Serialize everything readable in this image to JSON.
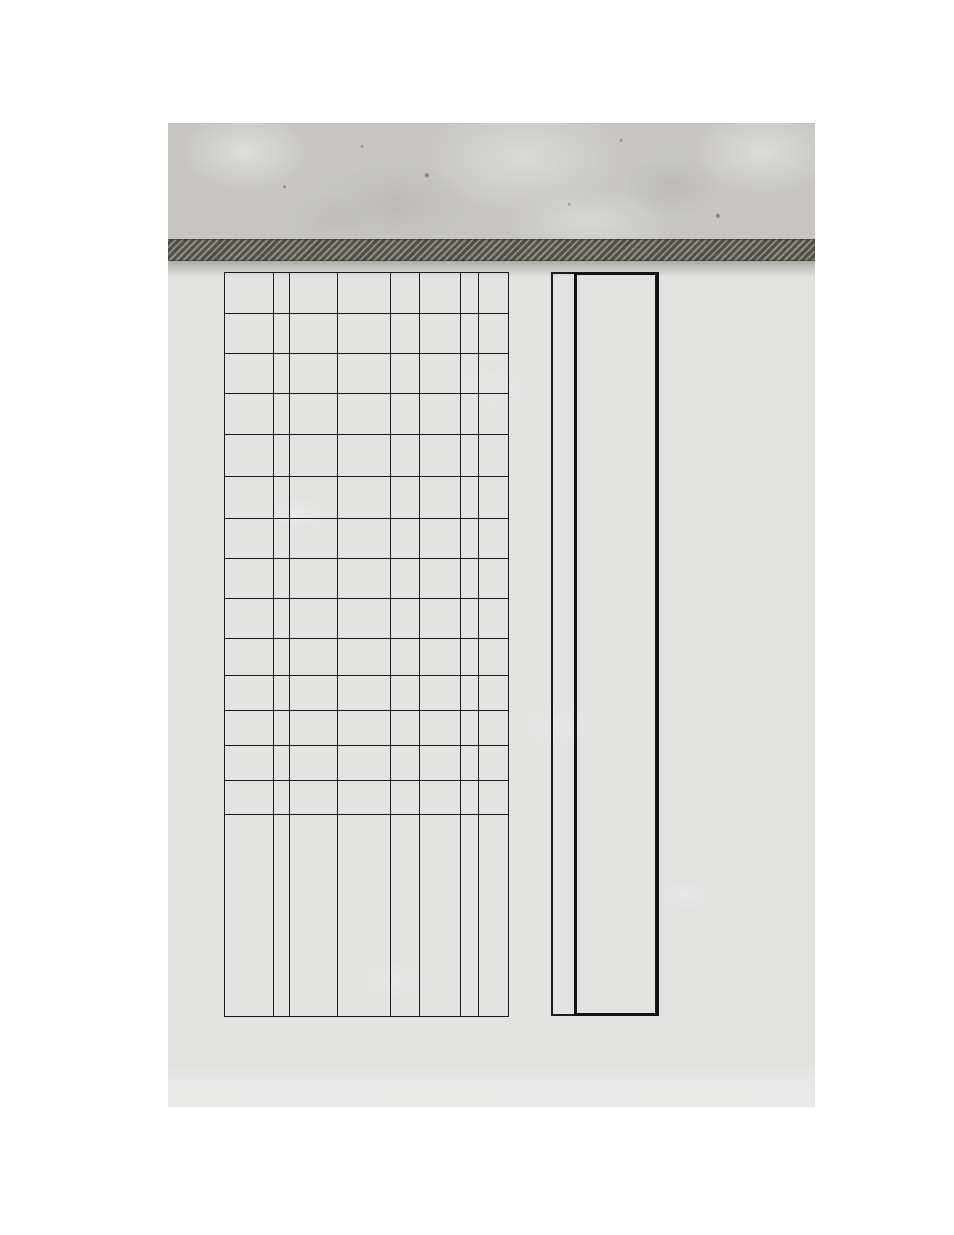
{
  "canvas": {
    "width_px": 954,
    "height_px": 1235,
    "background_color": "#ffffff"
  },
  "page": {
    "left_px": 168,
    "top_px": 123,
    "width_px": 647,
    "height_px": 984,
    "regions": {
      "concrete_header": {
        "height_px": 116,
        "base_color": "#c7c6c3"
      },
      "woven_band": {
        "top_px": 116,
        "height_px": 22,
        "base_color": "#66665a",
        "stripe_light": "#96968a",
        "stripe_dark": "#4e4e44"
      },
      "paper_body": {
        "top_px": 138,
        "color": "#e2e2e1"
      }
    }
  },
  "ledger_table": {
    "left_px": 56,
    "top_px": 149,
    "width_px": 284,
    "height_px": 744,
    "line_color": "#1a1a1a",
    "line_width_px": 1.5,
    "column_widths_px": [
      49,
      16,
      48,
      53,
      29,
      41,
      18,
      30
    ],
    "row_heights_px": [
      41,
      40,
      40,
      41,
      42,
      42,
      40,
      40,
      40,
      37,
      35,
      35,
      35,
      34,
      202
    ],
    "cell_text": ""
  },
  "side_box": {
    "left_px": 383,
    "top_px": 149,
    "width_px": 106,
    "height_px": 744,
    "outer_line_color": "#1b1b1b",
    "outer_line_width_px": 2,
    "heavy_line_color": "#131313",
    "heavy_line_width_px": 3,
    "divider_offset_px": 23,
    "narrow_column_text": "",
    "wide_column_text": ""
  }
}
